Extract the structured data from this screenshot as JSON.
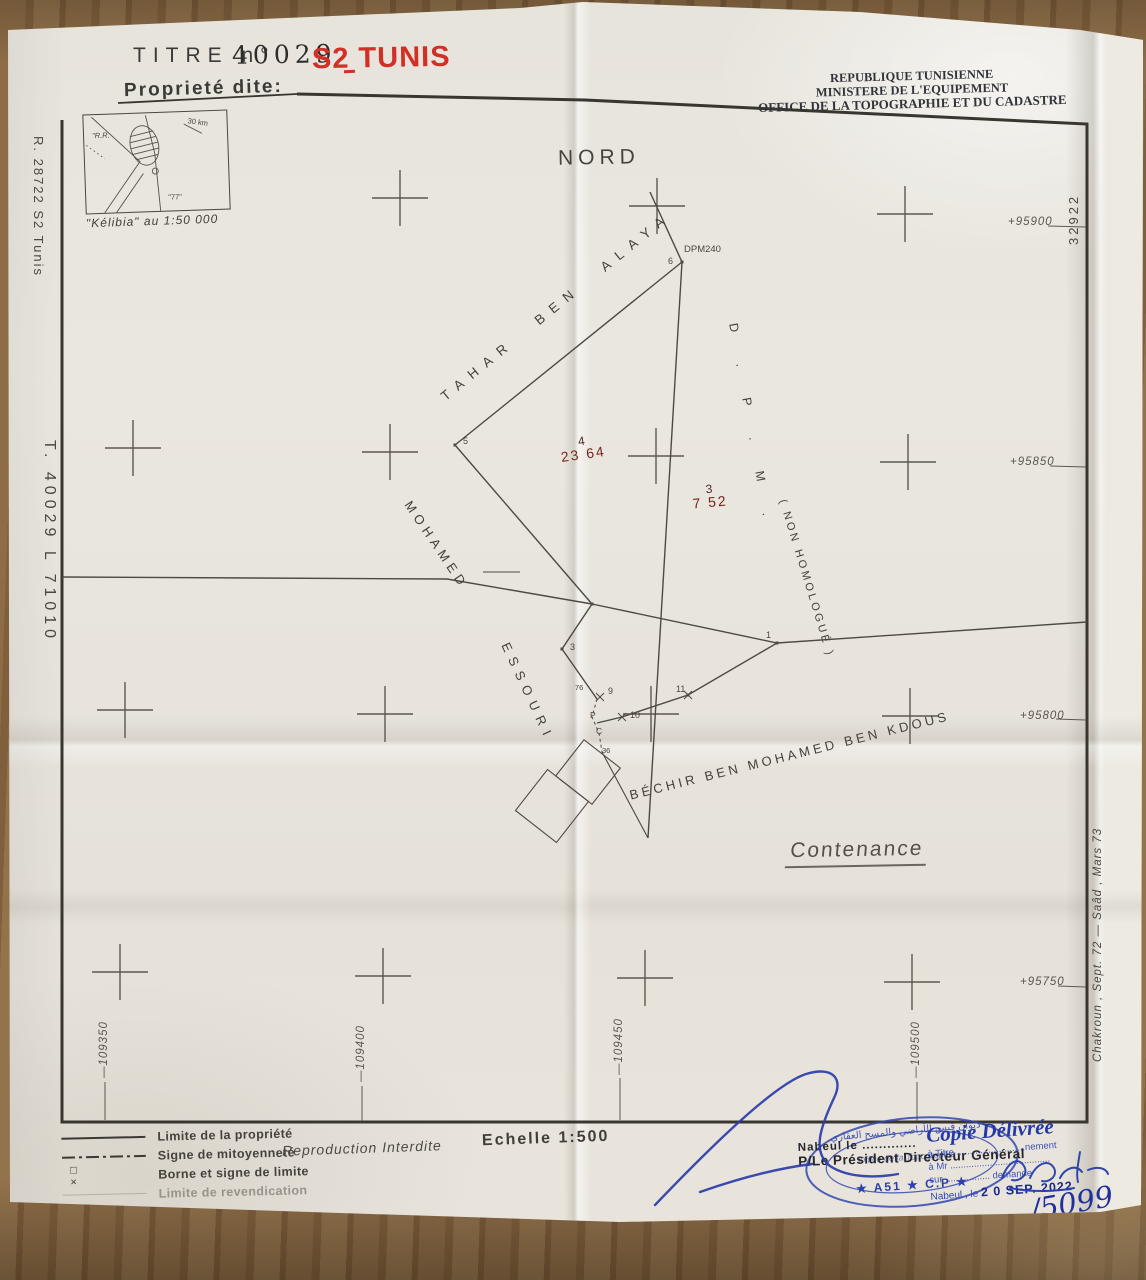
{
  "title_block": {
    "titre": "TITRE n°",
    "number": "40029",
    "series": "S2 TUNIS",
    "propriete": "Proprieté dite:"
  },
  "agency": {
    "l1": "REPUBLIQUE TUNISIENNE",
    "l2": "MINISTERE DE L'EQUIPEMENT",
    "l3": "OFFICE DE LA TOPOGRAPHIE ET DU CADASTRE"
  },
  "margin": {
    "left_top": "R. 28722    S2 Tunis",
    "left_bottom": "T. 40029 L 71010",
    "right_top": "32922",
    "right_bottom": "Chakroun , Sept. 72 — Saâd , Mars 73"
  },
  "inset": {
    "caption": "\"Kélibia\" au 1:50 000",
    "rr": "\"R.R.",
    "km": "30 km",
    "n77": "\"77\""
  },
  "map": {
    "nord": "NORD",
    "dpm240": "DPM240",
    "owners": {
      "tahar": "TAHAR  BEN  ALAYA",
      "mohamed": "MOHAMED",
      "essouri": "ESSOURI",
      "bechir": "BÉCHIR  BEN  MOHAMED  BEN  KDOUS",
      "dpm": "D . P . M .",
      "non_homologue": "( NON  HOMOLOGUÉ )"
    },
    "parcels": [
      {
        "num": "4",
        "area": "23 64"
      },
      {
        "num": "3",
        "area": "7 52"
      }
    ],
    "vertices": {
      "v5": "5",
      "v6": "6",
      "v3": "3",
      "v1": "1",
      "v9": "9",
      "v10": "10",
      "v11": "11",
      "v76": "76",
      "vp": "P",
      "vc": "C",
      "v36": "36"
    },
    "contenance": "Contenance",
    "grid_right": [
      "+95900",
      "+95850",
      "+95800",
      "+95750"
    ],
    "grid_bottom": [
      "—109350",
      "—109400",
      "—109450",
      "—109500"
    ]
  },
  "legend": {
    "items": [
      {
        "label": "Limite de la propriété"
      },
      {
        "label": "Signe de mitoyenneté"
      },
      {
        "label": "Borne et signe de limite"
      },
      {
        "label": "Limite de revendication"
      }
    ],
    "borne_symbols": "□ ×",
    "reproduction": "Reproduction Interdite",
    "echelle": "Echelle 1:500"
  },
  "stamps": {
    "oval": {
      "arabic": "ديوان قيس الأراضي والمسح العقاري",
      "org": "Office de la Topographie",
      "code": "★ A51 ★ C.P ★"
    },
    "director": {
      "l1": "Nabeul le .............",
      "l2": "P/Le Président Directeur Général"
    },
    "copie": {
      "title": "Copie Délivrée",
      "l1": "à Titre ..........................nement",
      "l2": "à Mr ......................................",
      "l3": "sur ................. demande",
      "l4": "Nabeul , le",
      "date": "2 0 SEP. 2022",
      "num": "/5099"
    }
  }
}
